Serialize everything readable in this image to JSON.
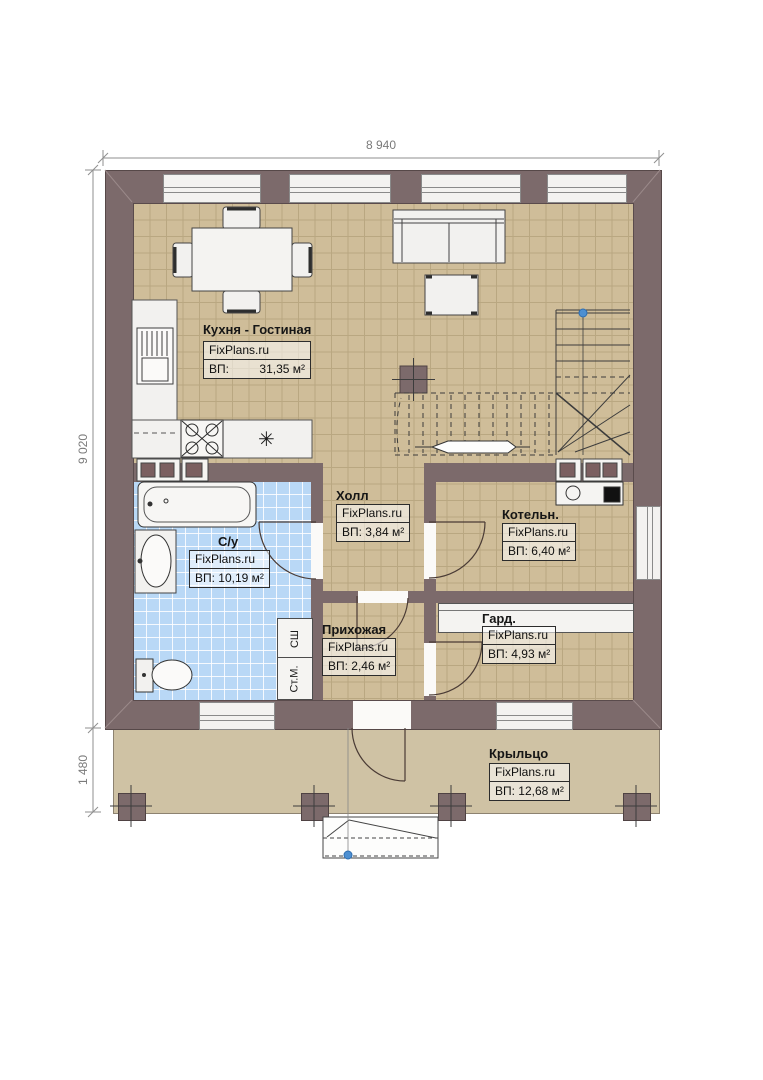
{
  "brand": "FixPlans.ru",
  "dimensions": {
    "width_top": "8 940",
    "height_left": "9 020",
    "porch_height": "1 480"
  },
  "rooms": {
    "kitchen_living": {
      "name": "Кухня - Гостиная",
      "area_label": "ВП:",
      "area_value": "31,35 м²"
    },
    "hall": {
      "name": "Холл",
      "area": "ВП: 3,84 м²"
    },
    "boiler": {
      "name": "Котельн.",
      "area": "ВП: 6,40 м²"
    },
    "bathroom": {
      "name": "С/у",
      "area": "ВП: 10,19 м²"
    },
    "entry_hall": {
      "name": "Прихожая",
      "area": "ВП: 2,46 м²"
    },
    "wardrobe": {
      "name": "Гард.",
      "area": "ВП: 4,93 м²"
    },
    "porch": {
      "name": "Крыльцо",
      "area": "ВП: 12,68 м²"
    }
  },
  "appliance_labels": {
    "dryer_cabinet": "СШ",
    "washing_machine": "Ст.М."
  },
  "symbols": {
    "kitchen_sink": "✳"
  },
  "colors": {
    "wall": "#7c6a6b",
    "floor": "#cfbd99",
    "bathroom_floor": "#b9d8f6",
    "porch_floor": "#cfc2a4",
    "marker_blue": "#4d8fd1"
  }
}
